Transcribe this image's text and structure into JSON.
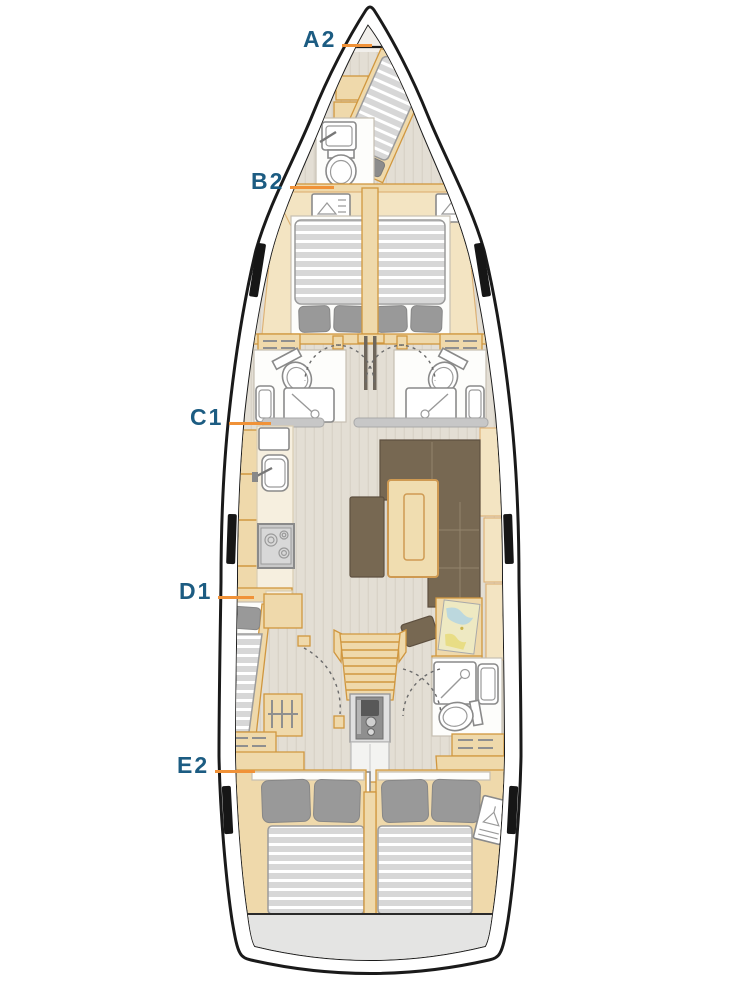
{
  "diagram": {
    "type": "sailing-yacht-interior-layout-plan",
    "labels": [
      {
        "id": "A2",
        "text": "A2"
      },
      {
        "id": "B2",
        "text": "B2"
      },
      {
        "id": "C1",
        "text": "C1"
      },
      {
        "id": "D1",
        "text": "D1"
      },
      {
        "id": "E2",
        "text": "E2"
      }
    ]
  },
  "colors": {
    "background": "#ffffff",
    "label_text": "#1c5c82",
    "leader_line": "#f09238",
    "hull_outline": "#1a1a1a",
    "deck_floor": "#e3ded4",
    "wood": "#efd9ab",
    "wood_border": "#d0973f",
    "wood_light": "#f3e4c2",
    "counter_cream": "#f6efdf",
    "fixture_white": "#ffffff",
    "counter_gray": "#c7c7c7",
    "mattress_gray": "#d9d9d9",
    "mattress_stripe": "#ffffff",
    "pillow_gray": "#999999",
    "upholstery_brown": "#776852",
    "transom_gray": "#e4e4e3",
    "chart_paper": "#eee9c2",
    "chart_water": "#bcd8de"
  }
}
